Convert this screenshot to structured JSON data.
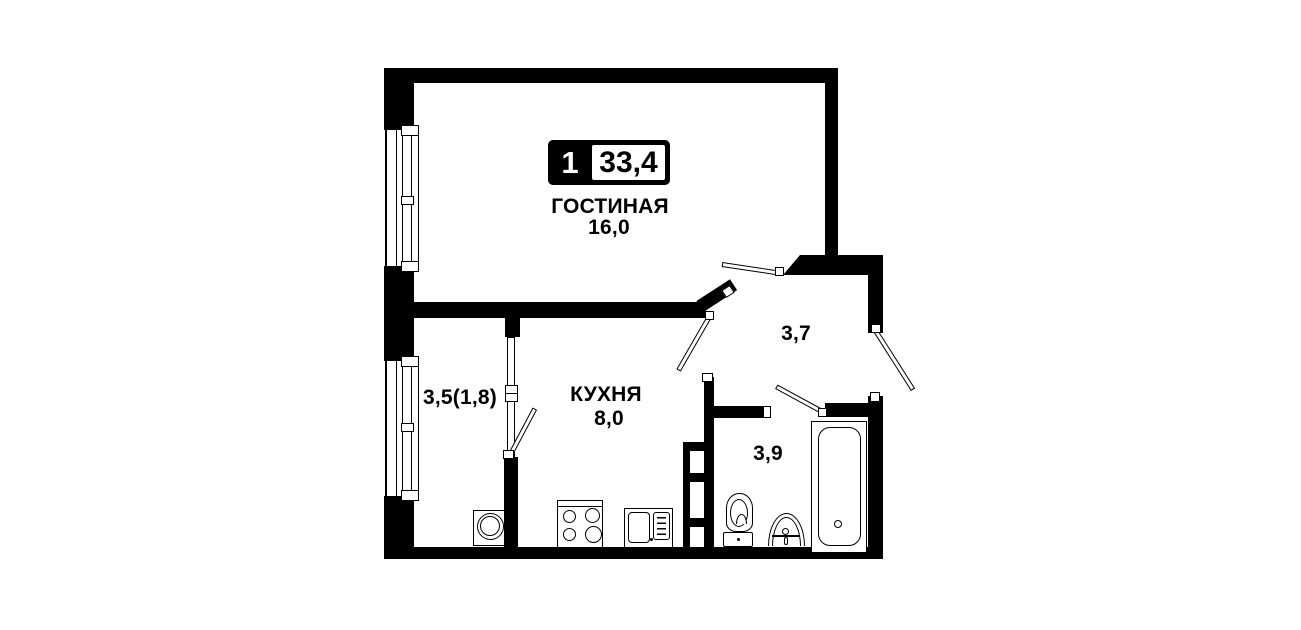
{
  "plan": {
    "badge": {
      "room_count": "1",
      "total_area": "33,4"
    },
    "rooms": {
      "living": {
        "name": "ГОСТИНАЯ",
        "area": "16,0"
      },
      "kitchen": {
        "name": "КУХНЯ",
        "area": "8,0"
      },
      "balcony": {
        "area": "3,5(1,8)"
      },
      "hallway": {
        "area": "3,7"
      },
      "bathroom": {
        "area": "3,9"
      }
    },
    "fixtures": [
      "washing-machine",
      "stove",
      "kitchen-sink",
      "vent-shaft",
      "toilet",
      "bathroom-sink",
      "bathtub"
    ],
    "colors": {
      "wall": "#000000",
      "background": "#ffffff"
    }
  }
}
